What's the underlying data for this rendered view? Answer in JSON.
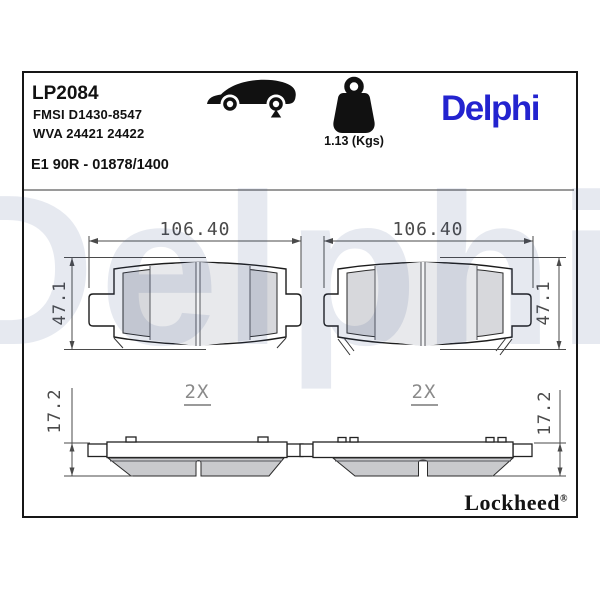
{
  "header": {
    "part_number": "LP2084",
    "fmsi_code": "FMSI D1430-8547",
    "wva_code": "WVA 24421 24422",
    "approval_code": "E1 90R - 01878/1400",
    "weight_label": "1.13 (Kgs)",
    "brand_logo": "Delphi",
    "brand_color": "#2323cf",
    "icons": {
      "vehicle": "car-rear-axle-icon",
      "mass": "weight-icon"
    }
  },
  "drawing": {
    "front_left": {
      "width": "106.40",
      "height": "47.1"
    },
    "front_right": {
      "width": "106.40",
      "height": "47.1"
    },
    "side_left": {
      "quantity": "2X",
      "thickness": "17.2"
    },
    "side_right": {
      "quantity": "2X",
      "thickness": "17.2"
    }
  },
  "footer": {
    "sub_brand": "Lockheed",
    "registered_mark": "®"
  },
  "watermark": {
    "text": "Delphi"
  }
}
